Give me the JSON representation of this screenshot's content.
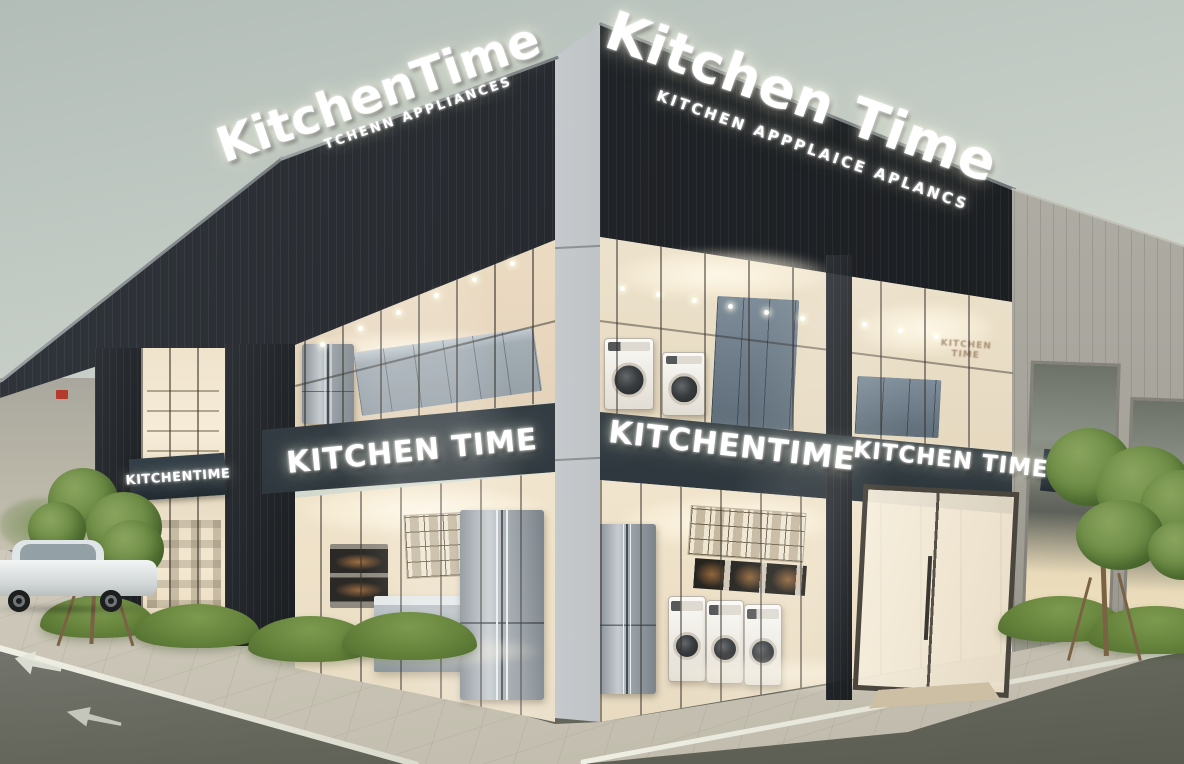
{
  "scene": {
    "store_name": "KitchenTime",
    "setting": "Modern glass corner storefront of a kitchen appliance store with illuminated 3D signage, showroom appliances behind floor-to-ceiling windows, sidewalk, street markings, young trees and a parked white car",
    "time_of_day": "overcast dusk"
  },
  "signs": {
    "main_left": {
      "title": "KitchenTime",
      "subtitle": "TCHENN APPLIANCES"
    },
    "main_right": {
      "title": "Kitchen Time",
      "subtitle": "KITCHEN APPPLAICE APLANCS"
    },
    "band_far_left": "KITCHENTIME",
    "band_left": "KITCHEN TIME",
    "band_center": "KITCHENTIME",
    "band_right": "KITCHEN TIME",
    "band_far_right_partial": "KITC",
    "band_right_edge_partial": "KIT",
    "interior_wall_text": "KITCHEN TIME"
  },
  "palette": {
    "sky_top": "#b3bdb8",
    "sky_horizon": "#eceedd",
    "fascia_dark": "#24272b",
    "sign_band": "#37424a",
    "corner_pillar": "#b7bbbe",
    "warm_interior": "#f3e8d3",
    "glass_frame_bronze": "#4a463e",
    "road": "#6b6d66",
    "sidewalk": "#d6d1c2",
    "foliage_green": "#71904a",
    "sign_text": "#ffffff"
  }
}
